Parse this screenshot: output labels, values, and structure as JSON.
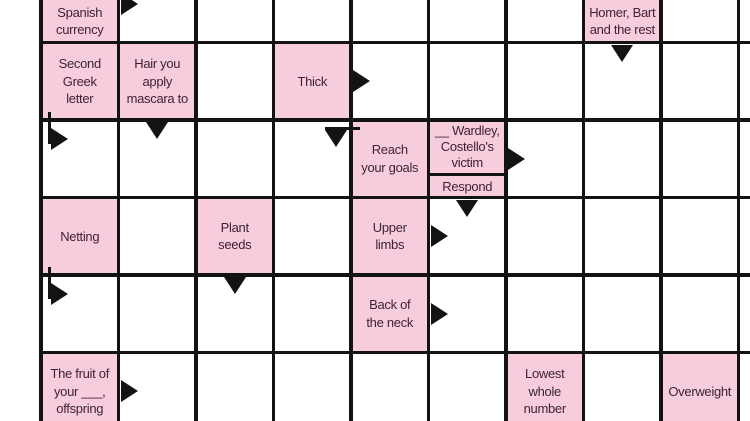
{
  "puzzle": {
    "type": "arrowword-crossword",
    "colors": {
      "clue_bg": "#f7ccdc",
      "cell_bg": "#ffffff",
      "line": "#131313",
      "text": "#3e2433"
    },
    "grid": {
      "cols": 10,
      "rows": 6,
      "cell_size": 77.5,
      "origin_x": 41,
      "origin_y": -35,
      "line_width": 3.5
    },
    "clues": [
      {
        "col": 0,
        "row": 0,
        "text": "Spanish\ncurrency",
        "align": "bottom"
      },
      {
        "col": 7,
        "row": 0,
        "text": "Homer, Bart\nand the rest",
        "align": "bottom"
      },
      {
        "col": 0,
        "row": 1,
        "text": "Second\nGreek\nletter"
      },
      {
        "col": 1,
        "row": 1,
        "text": "Hair you\napply\nmascara to"
      },
      {
        "col": 3,
        "row": 1,
        "text": "Thick"
      },
      {
        "col": 4,
        "row": 2,
        "text": "Reach\nyour goals"
      },
      {
        "col": 5,
        "row": 2,
        "text": "__ Wardley,\nCostello's\nvictim",
        "split_bottom_text": "Respond"
      },
      {
        "col": 0,
        "row": 3,
        "text": "Netting"
      },
      {
        "col": 2,
        "row": 3,
        "text": "Plant\nseeds"
      },
      {
        "col": 4,
        "row": 3,
        "text": "Upper\nlimbs"
      },
      {
        "col": 4,
        "row": 4,
        "text": "Back of\nthe neck"
      },
      {
        "col": 0,
        "row": 5,
        "text": "The fruit of\nyour ___,\noffspring"
      },
      {
        "col": 6,
        "row": 5,
        "text": "Lowest\nwhole\nnumber"
      },
      {
        "col": 8,
        "row": 5,
        "text": "Overweight"
      }
    ],
    "arrows": [
      {
        "col": 1,
        "row": 0,
        "kind": "across",
        "for_clue": "Spanish currency"
      },
      {
        "col": 7,
        "row": 1,
        "kind": "down",
        "for_clue": "Homer, Bart and the rest"
      },
      {
        "col": 4,
        "row": 1,
        "kind": "across",
        "for_clue": "Thick"
      },
      {
        "col": 0,
        "row": 2,
        "kind": "bent-across",
        "for_clue": "Second Greek letter"
      },
      {
        "col": 1,
        "row": 2,
        "kind": "down",
        "for_clue": "Hair you apply mascara to"
      },
      {
        "col": 3,
        "row": 2,
        "kind": "bent-down",
        "for_clue": "Reach your goals"
      },
      {
        "col": 6,
        "row": 2,
        "kind": "across",
        "for_clue": "__ Wardley, Costello's victim"
      },
      {
        "col": 5,
        "row": 3,
        "kind": "down",
        "for_clue": "Respond"
      },
      {
        "col": 5,
        "row": 3,
        "kind": "across",
        "for_clue": "Upper limbs"
      },
      {
        "col": 0,
        "row": 4,
        "kind": "bent-across",
        "for_clue": "Netting"
      },
      {
        "col": 2,
        "row": 4,
        "kind": "down",
        "for_clue": "Plant seeds"
      },
      {
        "col": 5,
        "row": 4,
        "kind": "across",
        "for_clue": "Back of the neck"
      },
      {
        "col": 1,
        "row": 5,
        "kind": "across",
        "for_clue": "The fruit of your ___, offspring"
      }
    ]
  }
}
